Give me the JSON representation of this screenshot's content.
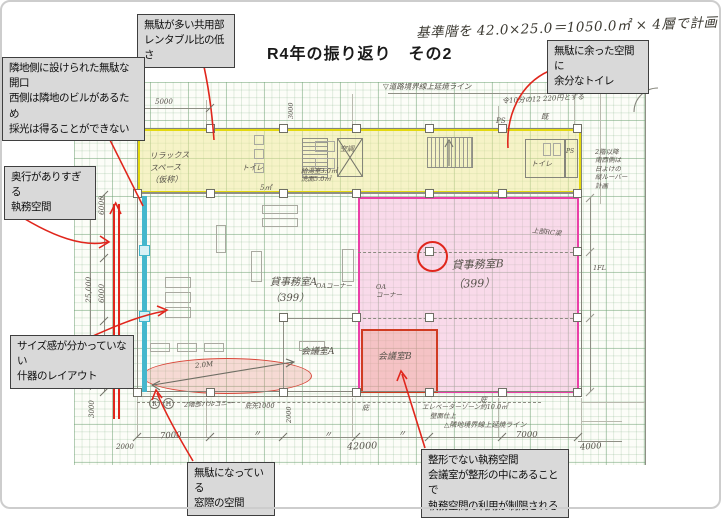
{
  "title": "R4年の振り返り　その2",
  "top_note": "基準階を 42.0×25.0＝1050.0㎡ × 4層で計画",
  "colors": {
    "annotation": "#e0261c",
    "common-area": "#e4d90f",
    "office-b": "#ea3fa8",
    "meeting-b": "#d03b22",
    "window-line": "#45b7cd"
  },
  "callouts": {
    "common_area": "無駄が多い共用部\nレンタブル比の低さ",
    "opening": "隣地側に設けられた無駄な開口\n西側は隣地のビルがあるため\n採光は得ることができない",
    "toilet": "無駄に余った空間に\n余分なトイレ",
    "depth": "奥行がありすぎる\n執務空間",
    "furniture": "サイズ感が分かっていない\n什器のレイアウト",
    "window": "無駄になっている\n窓際の空間",
    "shape": "整形でない執務空間\n会議室が整形の中にあることで\n執務空間の利用が制限される"
  },
  "rooms": {
    "relax": "リラックス\nスペース\n（仮称）",
    "toilet1": "トイレ",
    "toilet2": "トイレ",
    "kitchen": "給湯室3.0㎡\n洗面5.0㎡",
    "five": "5㎡",
    "ac": "空調",
    "ps_shaft": "PS",
    "office_a": "貸事務室A\n（399）",
    "office_b": "貸事務室B\n（399）",
    "meeting_a": "会議室A",
    "meeting_b": "会議室B",
    "oa1": "OAコーナー",
    "oa2": "OA\nコーナー"
  },
  "notes": {
    "road_line": "▽道路境界線上延焼ライン",
    "ratio_note": "令10分の12 220円とする",
    "existing": "既",
    "ps_top": "PS",
    "side_note": "2階以降\n南西側は\n日よけの\n縦ルーバー\n計画",
    "rc_beam": "上部RC梁",
    "fl_label": "1FL",
    "eaves1": "庇",
    "eaves2": "庇",
    "elevator": "エレベーターゾーン約10.0㎡",
    "wall_finish": "壁面仕上",
    "site_line": "△隣地境界線上延焼ライン",
    "balcony": "2階部バルコニー",
    "eaves_tip": "庇先1000",
    "arrow_label": "2.0M",
    "grid_r": "R",
    "grid_h": "H",
    "i_mark": "I"
  },
  "dims": {
    "d5000": "5000",
    "d2000": "2000",
    "d7000a": "7000",
    "d7000b": "7000",
    "ditto": "〃",
    "d42000": "42000",
    "d4000": "4000",
    "v6000": "6000",
    "v25000": "25,000",
    "v3000": "3000",
    "v3000top": "3000",
    "v2000": "2000"
  }
}
